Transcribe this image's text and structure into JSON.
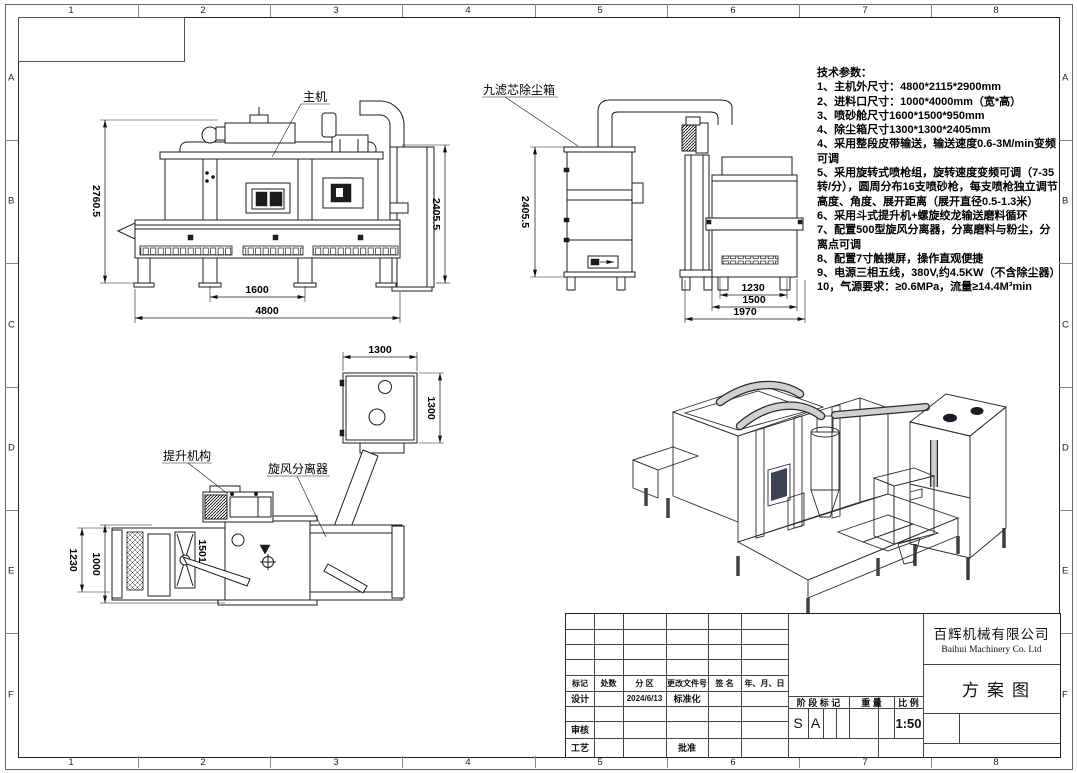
{
  "frame": {
    "col_labels": [
      "1",
      "2",
      "3",
      "4",
      "5",
      "6",
      "7",
      "8"
    ],
    "row_labels": [
      "A",
      "B",
      "C",
      "D",
      "E",
      "F"
    ]
  },
  "views": {
    "front": {
      "callout": "主机",
      "dim_height_left": "2760.5",
      "dim_height_right": "2405.5",
      "dim_width_inner": "1600",
      "dim_width_total": "4800"
    },
    "side": {
      "callout": "九滤芯除尘箱",
      "dim_height": "2405.5",
      "dim_w1": "1230",
      "dim_w2": "1500",
      "dim_w3": "1970"
    },
    "top": {
      "callout_elevator": "提升机构",
      "callout_cyclone": "旋风分离器",
      "dim_box_width": "1300",
      "dim_box_depth": "1300",
      "dim_left_outer": "1230",
      "dim_left_inner": "1000",
      "dim_inner": "1501"
    }
  },
  "tech_specs": {
    "title": "技术参数：",
    "items": [
      "1、主机外尺寸：4800*2115*2900mm",
      "2、进料口尺寸：1000*4000mm（宽*高）",
      "3、喷砂舱尺寸1600*1500*950mm",
      "4、除尘箱尺寸1300*1300*2405mm",
      "4、采用整段皮带输送，输送速度0.6-3M/min变频可调",
      "5、采用旋转式喷枪组，旋转速度变频可调（7-35转/分），圆周分布16支喷砂枪，每支喷枪独立调节高度、角度、展开距离（展开直径0.5-1.3米）",
      "6、采用斗式提升机+螺旋绞龙输送磨料循环",
      "7、配置500型旋风分离器，分离磨料与粉尘，分离点可调",
      "8、配置7寸触摸屏，操作直观便捷",
      "9、电源三相五线，380V,约4.5KW（不含除尘器）",
      "10，气源要求：≥0.6MPa，流量≥14.4M³min"
    ]
  },
  "title_block": {
    "rev_headers": [
      "标记",
      "处数",
      "分 区",
      "更改文件号",
      "签 名",
      "年、月、日"
    ],
    "design_label": "设计",
    "design_date": "2024/6/13",
    "standardization_label": "标准化",
    "review_label": "审核",
    "process_label": "工艺",
    "approve_label": "批准",
    "stage_header": "阶 段 标 记",
    "weight_header": "重 量",
    "scale_header": "比 例",
    "stage_mark_1": "S",
    "stage_mark_2": "A",
    "scale_value": "1:50",
    "company_cn": "百辉机械有限公司",
    "company_en": "Baihui Machinery Co. Ltd",
    "drawing_title": "方案图"
  },
  "iso_colors": {
    "top_blue": "#4a7cc0",
    "screen_blue": "#7f86d8",
    "accent_yellow": "#e6c229",
    "body_gray": "#cfd2cb"
  }
}
